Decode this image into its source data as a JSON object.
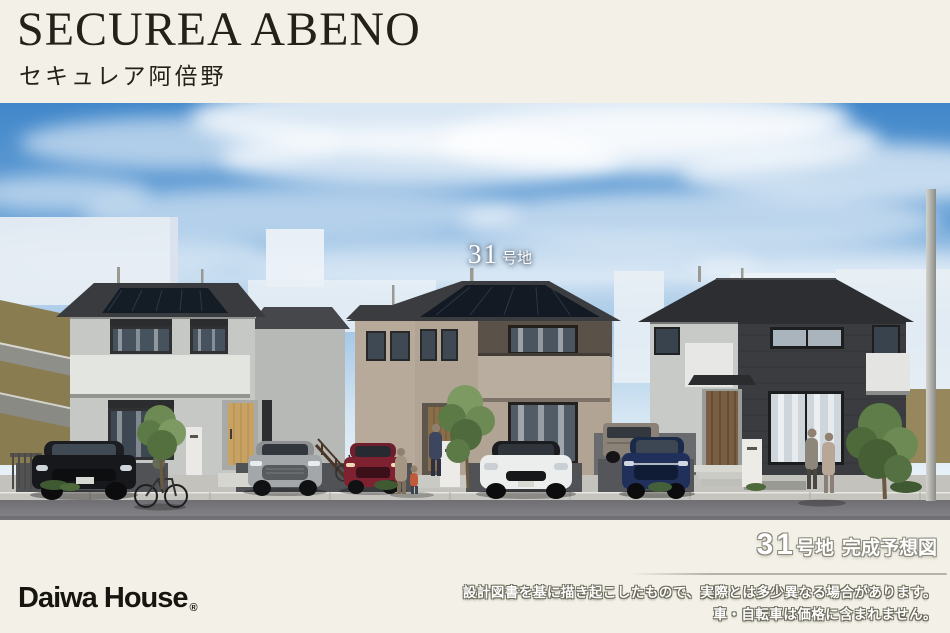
{
  "header": {
    "title": "SECUREA ABENO",
    "subtitle": "セキュレア阿倍野"
  },
  "overlay": {
    "lot_number": "31",
    "lot_suffix": "号地"
  },
  "footer": {
    "logo_text": "Daiwa House",
    "registered_mark": "®",
    "caption_number": "31",
    "caption_unit": "号地",
    "caption_label": "完成予想図",
    "disclaimer_line1": "設計図書を基に描き起こしたもので、実際とは多少異なる場合があります。",
    "disclaimer_line2": "車・自転車は価格に含まれません。"
  },
  "colors": {
    "page_background": "#f3f1e7",
    "title_text": "#23211a",
    "logo_text": "#17150f",
    "caption_text": "#ffffff",
    "caption_outline": "#8a887b",
    "sky_top": "#4187ca",
    "sky_horizon": "#e9f2f8",
    "road": "#76767a",
    "house_left_wall": "#c6c8c5",
    "house_center_wall": "#b1a494",
    "house_right_wall": "#3a3c3f"
  }
}
